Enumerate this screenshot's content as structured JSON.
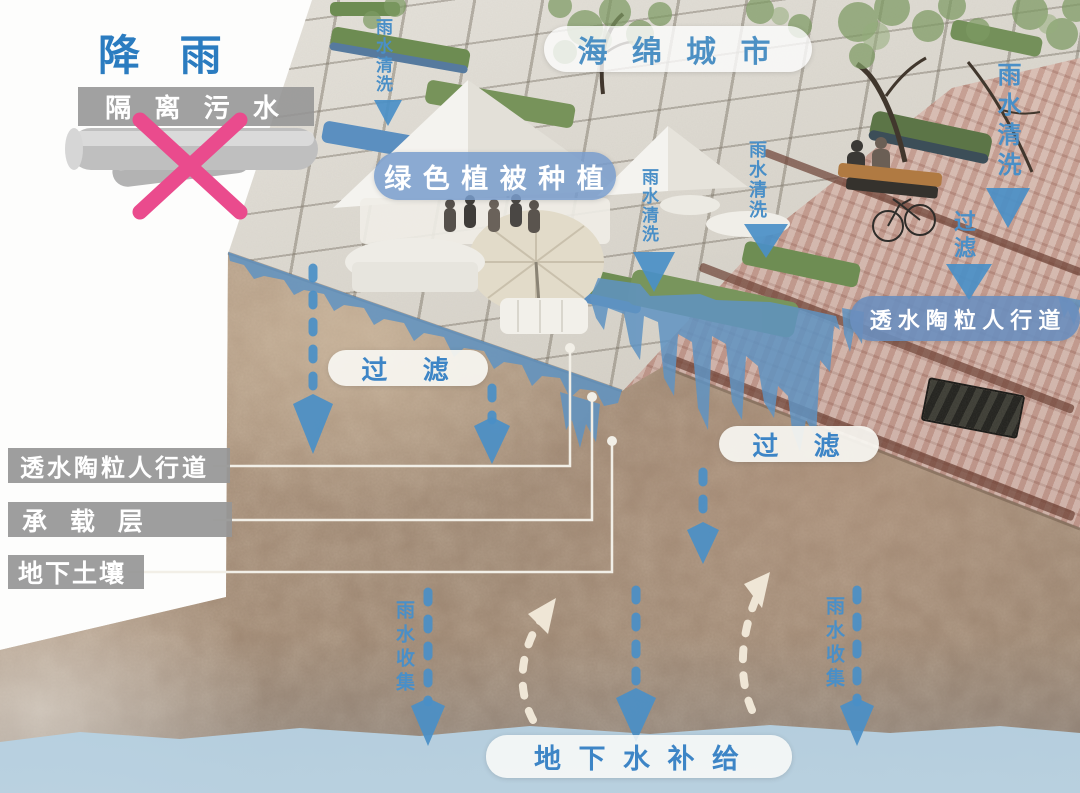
{
  "diagram": {
    "rainfall": "降 雨",
    "isolate_sewage": "隔 离 污 水",
    "sponge_city": "海 绵 城 市",
    "green_planting": "绿 色 植 被 种 植",
    "rain_wash": "雨水清洗",
    "filter_h": "过 滤",
    "filter_v": "过滤",
    "permeable_walkway_right": "透 水 陶 粒 人 行 道",
    "layer_permeable_walkway": "透水陶粒人行道",
    "layer_bearing": "承 载 层",
    "layer_subsoil": "地下土壤",
    "rain_collect": "雨水收集",
    "groundwater_recharge": "地 下 水 补 给"
  },
  "colors": {
    "accent_blue": "#3d85c6",
    "arrow_blue": "#4a8fc7",
    "pill_blue_bg": "#6e93c4",
    "label_gray": "#969696",
    "cross_pink": "#ea4b8d",
    "water_blue": "#8fb6d2",
    "soil_brown": "#a18a76",
    "white_arrow": "#efe6d6"
  }
}
